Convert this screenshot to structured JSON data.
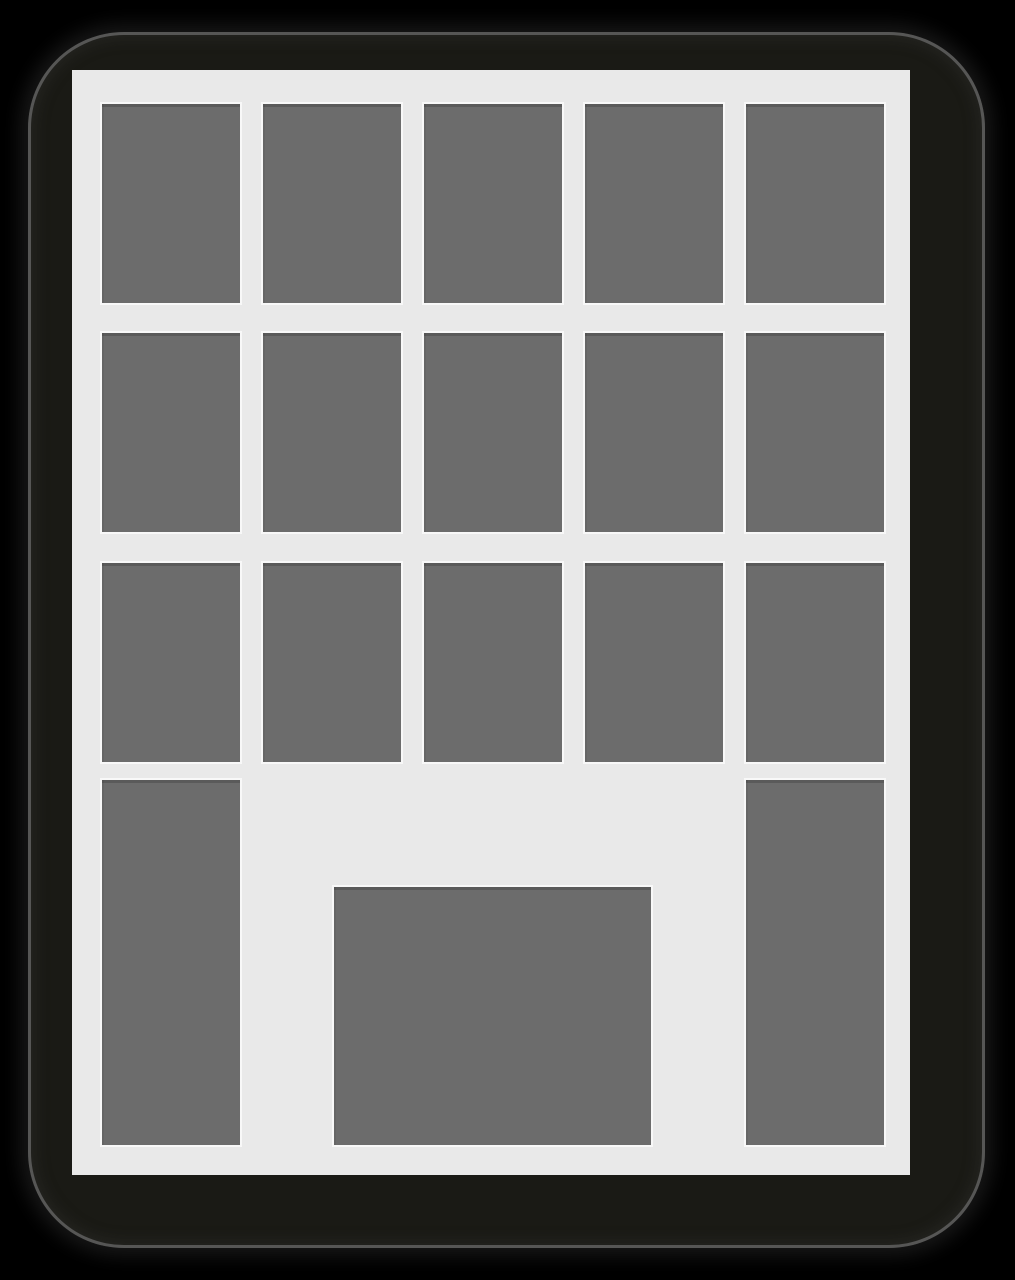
{
  "scene": {
    "description": "Flat pictogram of a multi-storey building: dark rounded-square body, light facade, gray windows and a centered door",
    "colors": {
      "canvas": "#000000",
      "body": "#1a1a15",
      "body_edge": "#5f5f5f",
      "facade": "#e9e9e9",
      "window": "#6c6c6c",
      "window_outline": "#f8f8f8"
    }
  },
  "building": {
    "upper_window_rows": 3,
    "upper_window_cols": 5,
    "upper_window_count": 15,
    "grid": {
      "col_x": [
        30,
        191,
        352,
        513,
        674
      ],
      "row_y": [
        34,
        263,
        493
      ],
      "window_w": 138,
      "window_h": 199
    },
    "side_windows": {
      "x": [
        30,
        674
      ],
      "y": 710,
      "w": 138,
      "h": 365
    },
    "door": {
      "x": 262,
      "y": 817,
      "w": 317,
      "h": 258
    }
  }
}
